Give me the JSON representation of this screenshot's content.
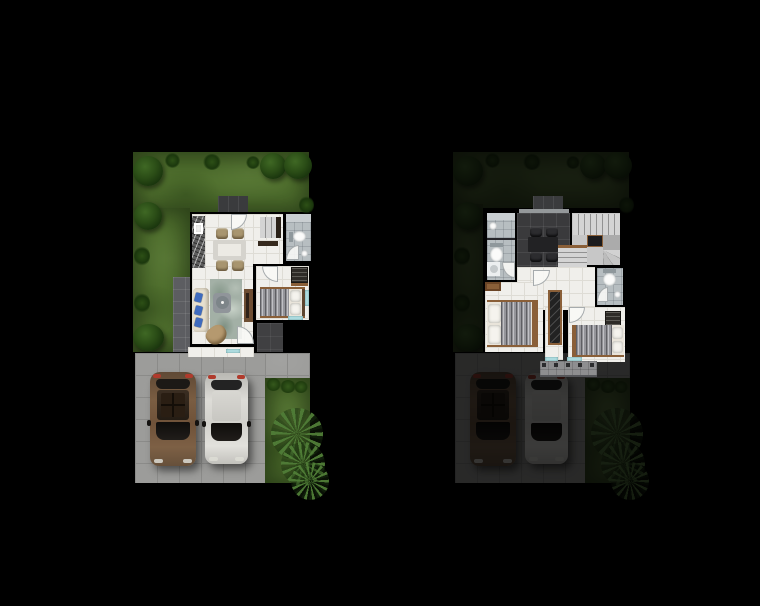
{
  "scene": {
    "type": "two-storey-house-floor-plan-render",
    "background": "#000000",
    "canvas": {
      "width": 760,
      "height": 606
    },
    "view": "top-down"
  },
  "palette": {
    "background": "#000000",
    "grass": "#50702e",
    "floor": "#f0efeb",
    "floor_line": "#dedcd5",
    "bath_floor": "#b7bec1",
    "vanity": "#c9ced1",
    "porcelain": "#fbfbfa",
    "dark_porch": "#3a3b3d",
    "side_porch": "#5c5d61",
    "patio": "#404042",
    "study_floor": "#3a3a3c",
    "drive": "#9c9c9a",
    "drive_line": "#8b8b89",
    "balcony": "#8e8e90",
    "sink": "#f2f2f0",
    "table_top": "#d5d3cd",
    "chair_tan": "#a8956f",
    "sofa": "#e7e0d0",
    "cushion_blue": "#3e6bbf",
    "rug": "#a3b0a6",
    "coffee_table": "#90959a",
    "armchair": "#b5996f",
    "wood": "#8a5f38",
    "wood_dark": "#5d452f",
    "console": "#6e4e33",
    "bed_base": "#e9e4da",
    "bed_drape": "#95959a",
    "pillow": "#f5f3ee",
    "wardrobe": "#2e2b27",
    "stair_tread": "#d4d4d4",
    "stair_riser": "#929292",
    "stair_landing": "#1b1b1d",
    "window_aqua": "#b5e3e6",
    "study_table": "#222224",
    "study_chair": "#2c2c2f",
    "car_tail": "#b03a2c",
    "car_light": "#ddddd5"
  },
  "plans": [
    {
      "id": "first-floor",
      "position": "left",
      "outdoor_dimmed": false,
      "outdoor": [
        "garden-lawn",
        "garden-trees",
        "grass-tufts",
        "entry-porch",
        "side-porch",
        "driveway",
        "garden-strip",
        "hedge-bushes",
        "palm-tree",
        "car-brown",
        "car-silver"
      ],
      "rooms": [
        {
          "name": "kitchen",
          "furniture": [
            "granite-counter",
            "kitchen-sink"
          ]
        },
        {
          "name": "dining-area",
          "furniture": [
            "dining-table",
            "dining-chair",
            "dining-chair",
            "dining-chair",
            "dining-chair"
          ]
        },
        {
          "name": "living-room",
          "furniture": [
            "sofa",
            "blue-cushions",
            "area-rug",
            "coffee-table",
            "armchair",
            "tv-console"
          ]
        },
        {
          "name": "bathroom",
          "furniture": [
            "vanity",
            "toilet",
            "washbasin"
          ]
        },
        {
          "name": "staircase",
          "furniture": []
        },
        {
          "name": "bedroom",
          "furniture": [
            "double-bed",
            "wardrobe"
          ]
        },
        {
          "name": "rear-patio",
          "furniture": []
        },
        {
          "name": "front-terrace",
          "furniture": []
        }
      ]
    },
    {
      "id": "second-floor",
      "position": "right",
      "outdoor_dimmed": true,
      "outdoor": [
        "garden-lawn",
        "garden-trees",
        "grass-tufts",
        "driveway",
        "garden-strip",
        "hedge-bushes",
        "palm-tree",
        "car-brown",
        "car-silver"
      ],
      "rooms": [
        {
          "name": "bathroom-1",
          "furniture": [
            "washbasin",
            "toilet",
            "washing-machine"
          ]
        },
        {
          "name": "family-room",
          "furniture": [
            "table",
            "chair",
            "chair",
            "chair",
            "chair"
          ]
        },
        {
          "name": "staircase",
          "furniture": [
            "upper-flight",
            "landing",
            "winder-steps",
            "lower-flight"
          ]
        },
        {
          "name": "hallway",
          "furniture": [
            "closet-unit"
          ]
        },
        {
          "name": "master-bedroom",
          "furniture": [
            "double-bed",
            "dresser"
          ]
        },
        {
          "name": "bathroom-2",
          "furniture": [
            "toilet",
            "washbasin"
          ]
        },
        {
          "name": "bedroom-2",
          "furniture": [
            "double-bed",
            "wardrobe"
          ]
        },
        {
          "name": "balcony",
          "furniture": [
            "railing-posts"
          ]
        }
      ]
    }
  ]
}
